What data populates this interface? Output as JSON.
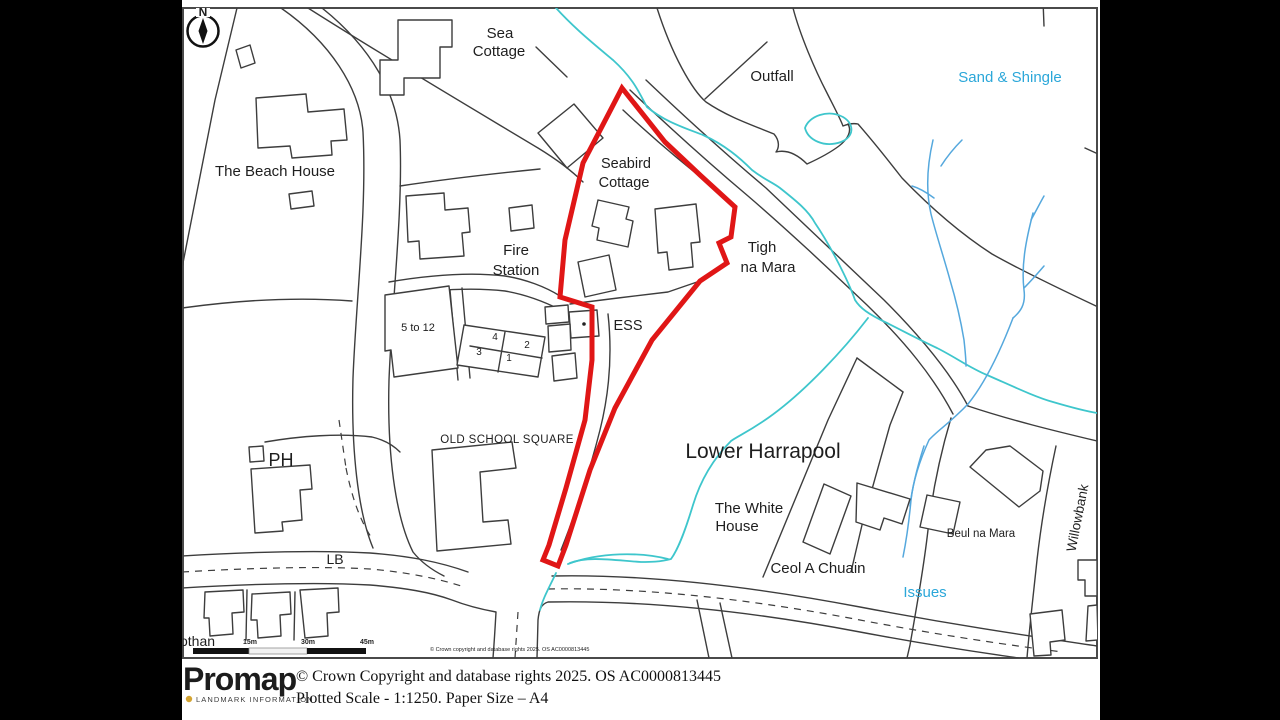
{
  "map": {
    "compass_label": "N",
    "labels": {
      "sea_cottage": [
        "Sea",
        "Cottage"
      ],
      "outfall": "Outfall",
      "sand_and_shingle": "Sand & Shingle",
      "the_beach_house": "The Beach House",
      "seabird_cottage": [
        "Seabird",
        "Cottage"
      ],
      "fire_station": [
        "Fire",
        "Station"
      ],
      "tigh_na_mara": [
        "Tigh",
        "na Mara"
      ],
      "ess": "ESS",
      "five_to_twelve": "5 to 12",
      "unit_numbers": [
        "4",
        "2",
        "3",
        "1"
      ],
      "old_school_square": "OLD SCHOOL SQUARE",
      "ph": "PH",
      "lower_harrapool": "Lower Harrapool",
      "the_white_house": [
        "The White",
        "House"
      ],
      "ceol_a_chuain": "Ceol A Chuain",
      "beul_na_mara": "Beul na Mara",
      "willowbank": "Willowbank",
      "issues": "Issues",
      "lb": "LB",
      "othan": "othan"
    },
    "scale_bar": {
      "ticks": [
        "15m",
        "30m",
        "45m"
      ]
    },
    "copyright_small": "© Crown copyright and database rights 2025. OS AC0000813445",
    "colors": {
      "boundary_red": "#e01616",
      "stream_teal": "#3ec6cc",
      "stream_blue": "#55a8dd",
      "water_label_blue": "#2ba7d9",
      "logo_gold": "#d4a432"
    }
  },
  "footer": {
    "logo_text": "Promap",
    "logo_subtext": "LANDMARK INFORMATION",
    "copyright_line1": "© Crown Copyright and database rights 2025. OS AC0000813445",
    "copyright_line2": "Plotted Scale - 1:1250. Paper Size – A4"
  }
}
